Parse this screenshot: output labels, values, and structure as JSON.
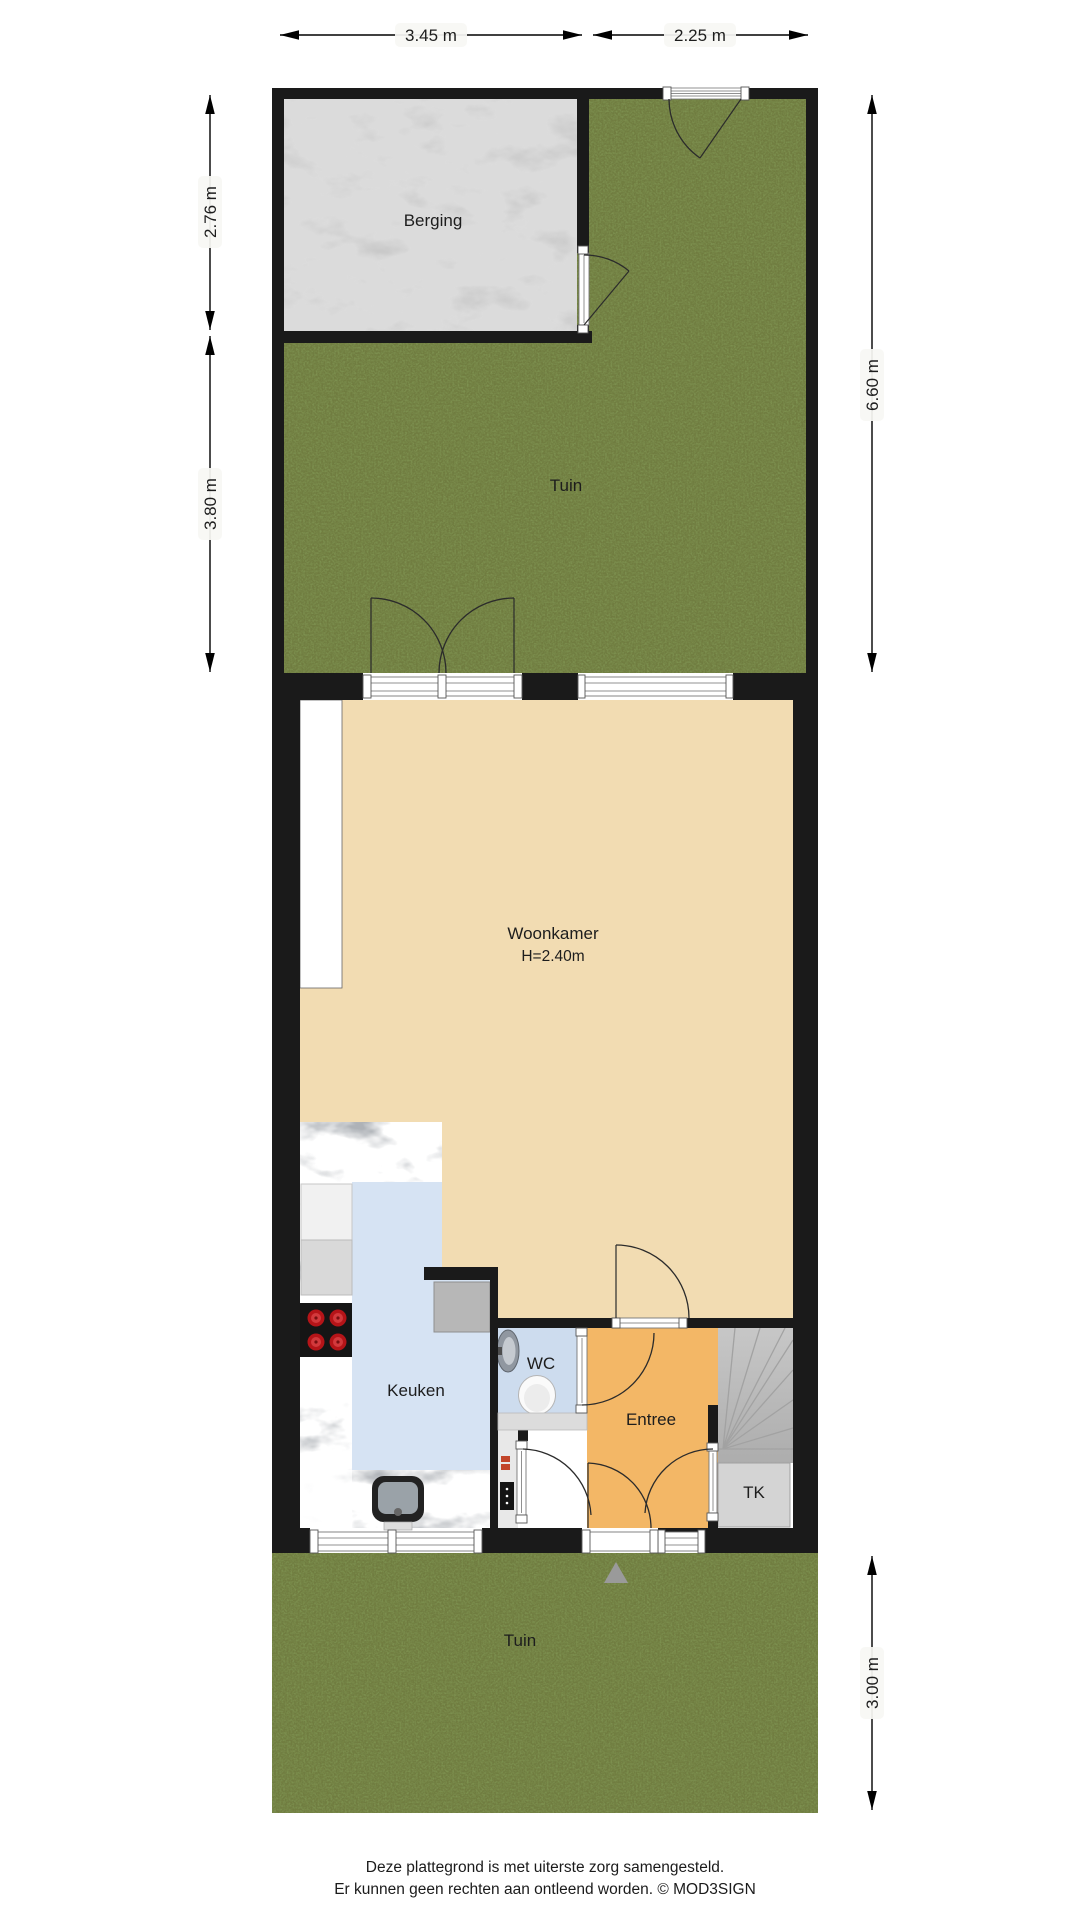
{
  "plan": {
    "rooms": {
      "berging": "Berging",
      "tuin_boven": "Tuin",
      "woonkamer": "Woonkamer",
      "woonkamer_hoogte": "H=2.40m",
      "keuken": "Keuken",
      "wc": "WC",
      "entree": "Entree",
      "tk": "TK",
      "tuin_onder": "Tuin"
    },
    "dimensions": {
      "top_berging": "3.45 m",
      "top_tuin": "2.25 m",
      "left_berging": "2.76 m",
      "left_tuin": "3.80 m",
      "right_tuin_boven": "6.60 m",
      "right_tuin_onder": "3.00 m"
    },
    "colors": {
      "wall": "#1a1a1a",
      "grass": "#7d9150",
      "berging_floor": "#c9c9c9",
      "woonkamer_floor": "#f2dcb2",
      "keuken_floor": "#d6e3f3",
      "wc_floor": "#cddcee",
      "entree_floor": "#f3b766",
      "counter": "#aeb2b7",
      "stairs": "#bdbdbd",
      "tk_floor": "#d4d4d4",
      "niche": "#ffffff"
    },
    "footer": {
      "line1": "Deze plattegrond is met uiterste zorg samengesteld.",
      "line2": "Er kunnen geen rechten aan ontleend worden. © MOD3SIGN"
    }
  }
}
